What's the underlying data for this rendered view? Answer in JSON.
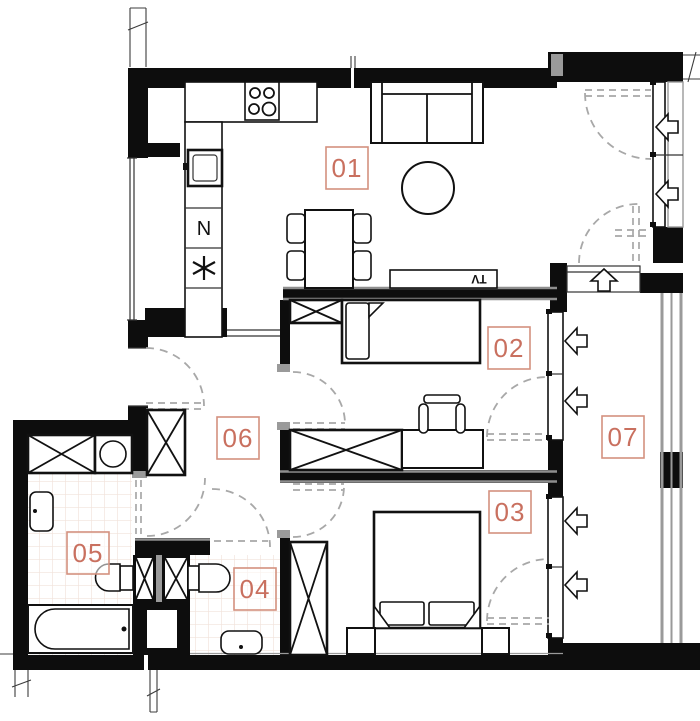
{
  "title": "Apartment floor plan",
  "palette": {
    "wall": "#0d0d0d",
    "label_text": "#c9705f",
    "label_border": "#d4917f",
    "door_arc": "#a8a8a8",
    "glass_railing": "#9a9a9a",
    "tile_line": "#f1e2da"
  },
  "rooms": [
    {
      "id": "01",
      "name": "living-room-with-kitchenette"
    },
    {
      "id": "02",
      "name": "bedroom-small"
    },
    {
      "id": "03",
      "name": "bedroom-main"
    },
    {
      "id": "04",
      "name": "toilet"
    },
    {
      "id": "05",
      "name": "bathroom"
    },
    {
      "id": "06",
      "name": "hallway"
    },
    {
      "id": "07",
      "name": "balcony"
    }
  ],
  "annotations": {
    "tv_cabinet": "TV",
    "kitchen_appliance": "N"
  },
  "icons": {
    "freezer_symbol": "six-spoke-asterisk",
    "window_opening_direction": "block-arrow",
    "door_swing": "dashed-quarter-arc",
    "shaft": "crossed-box"
  }
}
